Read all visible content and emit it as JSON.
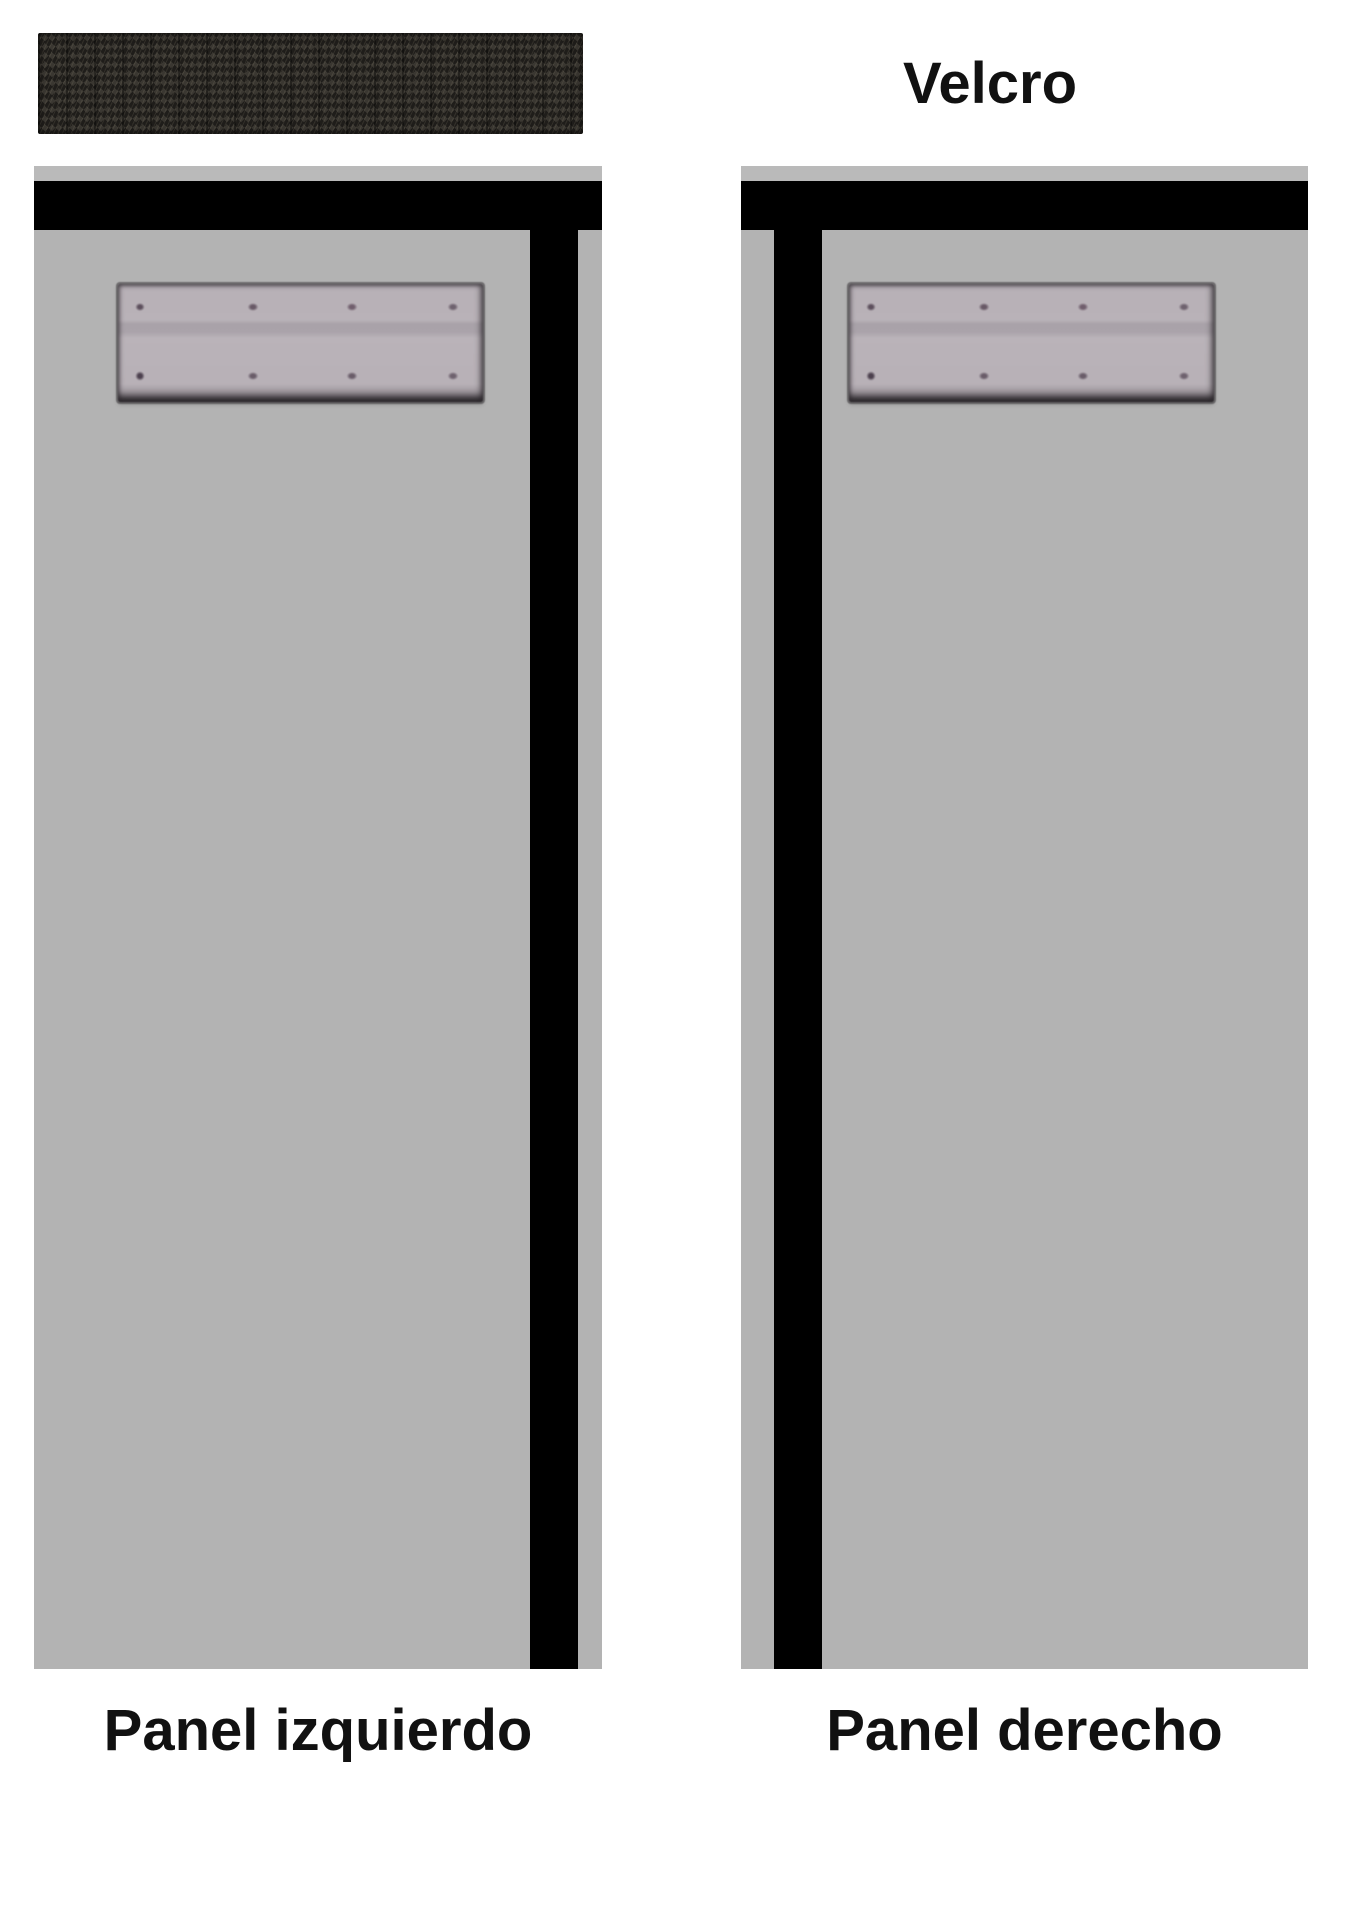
{
  "velcro": {
    "label": "Velcro",
    "strip_texture": "velcro-hook-fabric"
  },
  "panels": {
    "left": {
      "label": "Panel izquierdo"
    },
    "right": {
      "label": "Panel derecho"
    }
  },
  "hinge": {
    "description": "hinge-plate-with-screws",
    "screw_rows": 2,
    "screws_per_row": 4
  },
  "colors": {
    "background": "#ffffff",
    "panel_gray": "#b3b3b3",
    "top_strip_gray": "#bababa",
    "bar_black": "#000000",
    "hinge_plate_gray": "#b6afb6",
    "velcro_dark": "#262420",
    "label_text": "#111111"
  }
}
